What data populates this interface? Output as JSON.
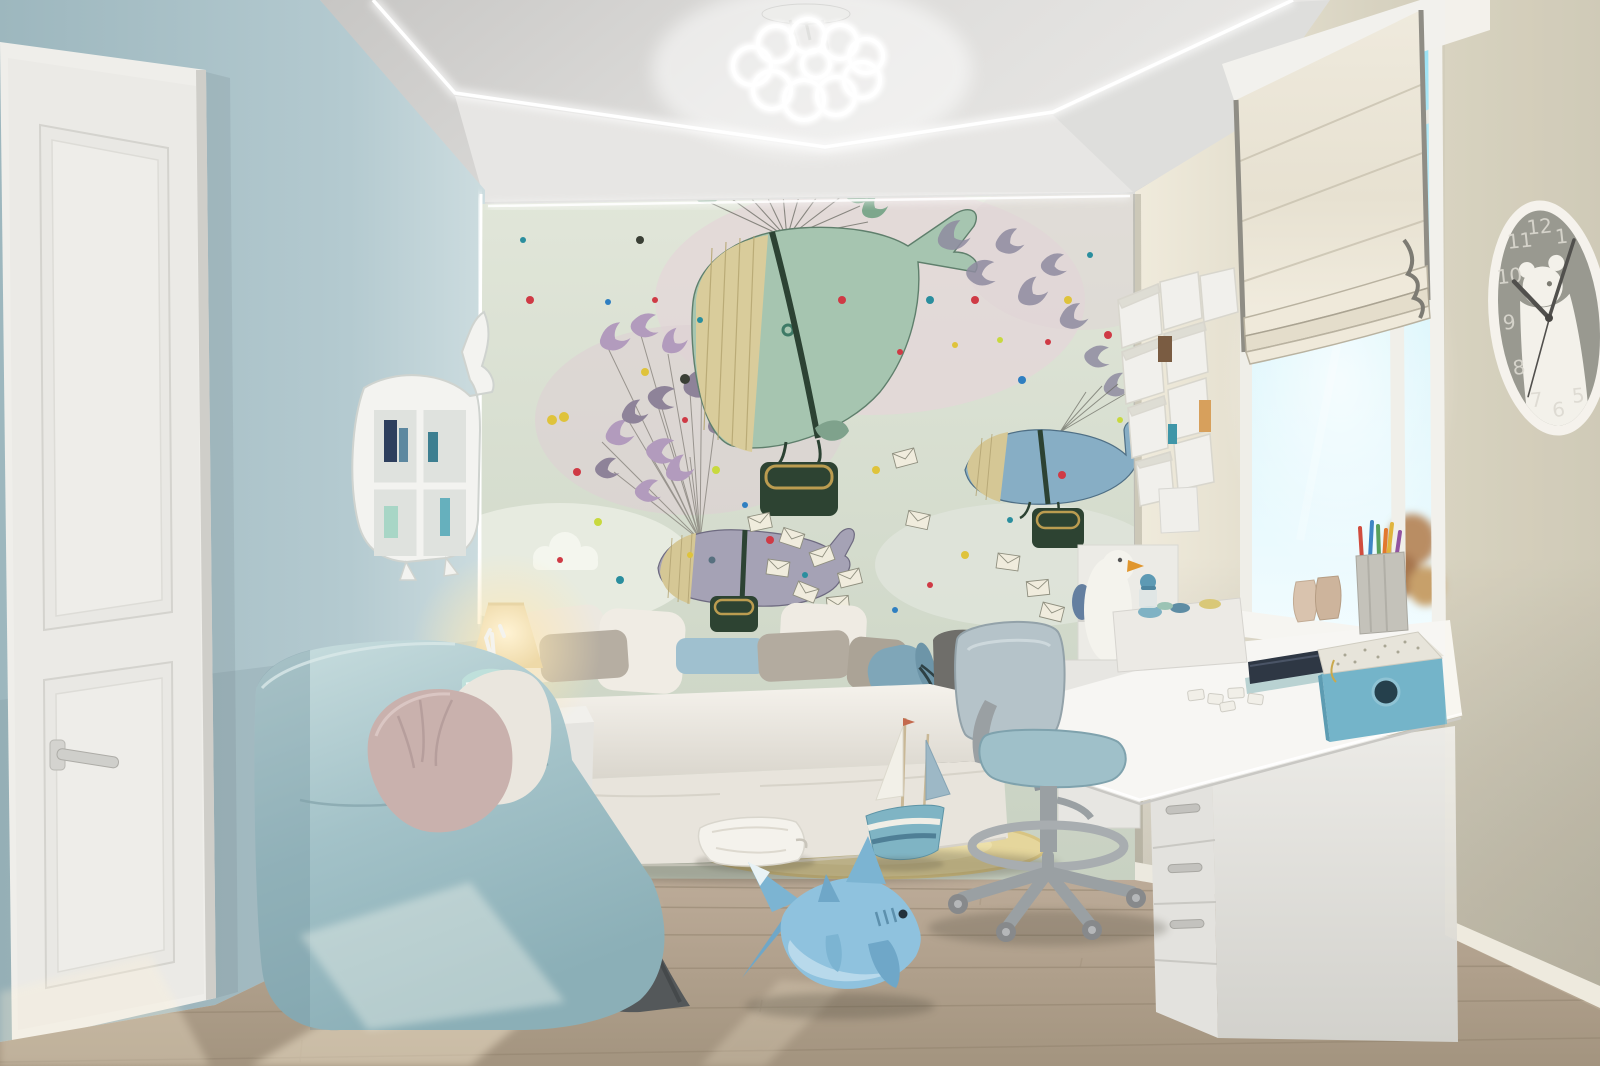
{
  "meta": {
    "title": "Children's bedroom interior render",
    "style": "photoreal 3D visualization, pastel blue and white nursery with whale mural"
  },
  "palette": {
    "wall_left_blue": "#aec6cc",
    "wall_right_beige": "#d3cebc",
    "ceiling_grey": "#dcdbd9",
    "mural_bg": "#d4dccd",
    "mural_cloud_pink": "#e2d6d7",
    "whale_green": "#a6c5b0",
    "whale_blue": "#87aec5",
    "whale_grey": "#a5a2b5",
    "whale_belly_yellow": "#dbce9d",
    "basket_green": "#2e4634",
    "bird_purple": "#b29bbd",
    "envelope_cream": "#f0ecdd",
    "door_white": "#efeeea",
    "floor_wood": "#b7a795",
    "bed_white": "#f0ede7",
    "armchair_blue": "#a5c3c9",
    "pillow_pink": "#c9b1ad",
    "blanket_grey": "#54585a",
    "desk_white": "#f7f6f3",
    "chair_seat_blue": "#9fc0c9",
    "storage_box_teal": "#74b4c9",
    "rug_yellow": "#e6d69b",
    "shark_blue": "#8fc2de",
    "lamp_glow": "#ffe9b4",
    "sky_cyan": "#9fe8f8",
    "led_white": "#ffffff",
    "clock_face_grey": "#8b8c86",
    "dot_red": "#cf3a45",
    "dot_yellow": "#dfc33b",
    "dot_teal": "#2a8e9e",
    "dot_blue": "#2f7fc1",
    "dot_lime": "#c8d93e",
    "dot_dark": "#3a3f35"
  },
  "clock": {
    "numerals": [
      "12",
      "1",
      "11",
      "10",
      "9",
      "8",
      "7",
      "6",
      "5"
    ],
    "time_hint": "hands near 10:07 with second hand toward 7",
    "decoration": "white polar bear silhouette on grey face"
  },
  "scene": {
    "objects": [
      "white paneled door on blue wall",
      "whale-shaped white wall shelf with small books",
      "wall mural: whales carried by bird flocks dropping letter envelopes, confetti dots, clouds",
      "ceiling LED light strips in angular zigzag",
      "flower-shaped ring chandelier",
      "white daybed with white, grey and blue pillows and blue bolster",
      "light blue lounge armchair with pink and white pillows",
      "dark grey throw blanket",
      "white nightstand with glowing table lamp and figurine",
      "white corner desk with 4-drawer unit",
      "desk chair with light blue cushions and foot ring",
      "teal storage box with speckled lid, notebooks, puzzle pieces, white toy box",
      "white geometric box shelves on window wall",
      "seagull figurine on white shelf",
      "window with cream roman shade, sunlight and sky view",
      "bear wall clock",
      "round yellow rug with white pillow",
      "toy sailboat",
      "plush shark toy on wooden floor"
    ]
  },
  "mural": {
    "dots": [
      [
        530,
        300,
        4,
        "red"
      ],
      [
        552,
        420,
        5,
        "yellow"
      ],
      [
        523,
        240,
        3,
        "teal"
      ],
      [
        577,
        472,
        4,
        "red"
      ],
      [
        608,
        302,
        3,
        "blue"
      ],
      [
        598,
        522,
        4,
        "lime"
      ],
      [
        560,
        560,
        3,
        "red"
      ],
      [
        640,
        240,
        4,
        "dark"
      ],
      [
        655,
        300,
        3,
        "red"
      ],
      [
        700,
        320,
        3,
        "teal"
      ],
      [
        645,
        372,
        4,
        "yellow"
      ],
      [
        685,
        420,
        3,
        "red"
      ],
      [
        716,
        470,
        4,
        "lime"
      ],
      [
        745,
        505,
        3,
        "blue"
      ],
      [
        770,
        540,
        4,
        "red"
      ],
      [
        805,
        575,
        3,
        "teal"
      ],
      [
        842,
        300,
        4,
        "red"
      ],
      [
        876,
        470,
        4,
        "yellow"
      ],
      [
        900,
        352,
        3,
        "red"
      ],
      [
        930,
        300,
        4,
        "teal"
      ],
      [
        955,
        345,
        3,
        "yellow"
      ],
      [
        975,
        300,
        4,
        "red"
      ],
      [
        1000,
        340,
        3,
        "lime"
      ],
      [
        1022,
        380,
        4,
        "blue"
      ],
      [
        1048,
        342,
        3,
        "red"
      ],
      [
        1068,
        300,
        4,
        "yellow"
      ],
      [
        1090,
        255,
        3,
        "teal"
      ],
      [
        1108,
        335,
        4,
        "red"
      ],
      [
        1120,
        420,
        3,
        "lime"
      ],
      [
        1062,
        475,
        4,
        "red"
      ],
      [
        1010,
        520,
        3,
        "teal"
      ],
      [
        965,
        555,
        4,
        "yellow"
      ],
      [
        930,
        585,
        3,
        "red"
      ],
      [
        895,
        610,
        3,
        "blue"
      ],
      [
        620,
        580,
        4,
        "teal"
      ],
      [
        690,
        555,
        3,
        "yellow"
      ],
      [
        685,
        379,
        5,
        "dark"
      ],
      [
        564,
        417,
        5,
        "yellow"
      ]
    ],
    "envelopes": [
      [
        905,
        458,
        -15
      ],
      [
        1008,
        562,
        8
      ],
      [
        1038,
        588,
        -6
      ],
      [
        1052,
        612,
        14
      ],
      [
        760,
        522,
        -12
      ],
      [
        792,
        538,
        18
      ],
      [
        822,
        556,
        -20
      ],
      [
        778,
        568,
        8
      ],
      [
        850,
        578,
        -14
      ],
      [
        806,
        592,
        22
      ],
      [
        838,
        604,
        -6
      ],
      [
        918,
        520,
        12
      ]
    ]
  }
}
